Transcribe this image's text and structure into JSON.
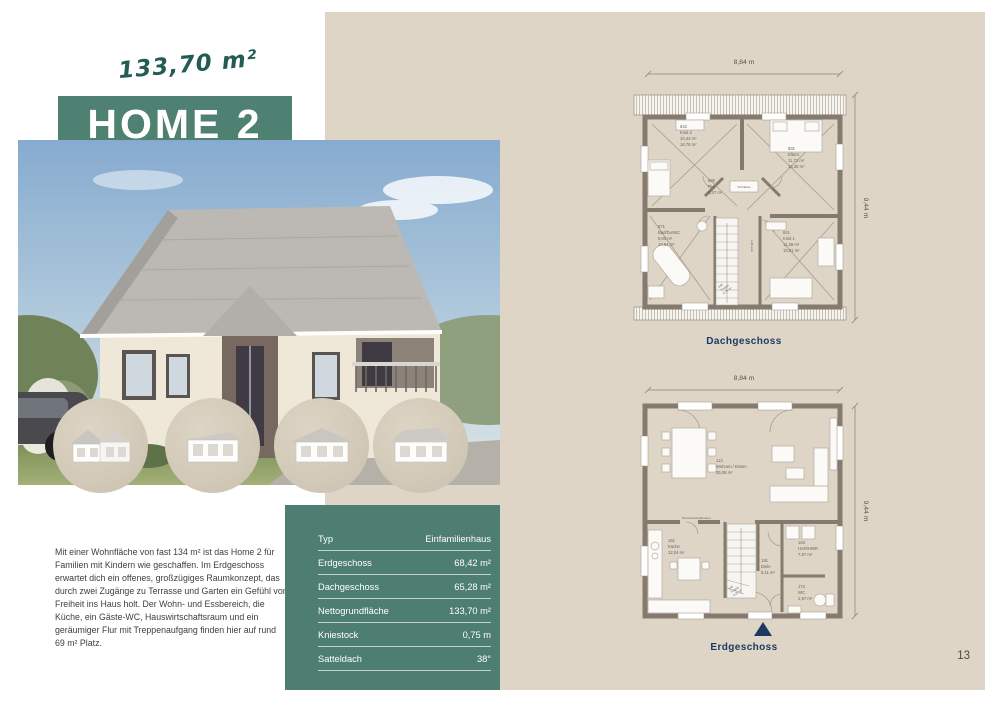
{
  "page": {
    "number": "13"
  },
  "header": {
    "area_label": "133,70 m²",
    "title": "HOME 2"
  },
  "intro": {
    "text": "Mit einer Wohnfläche von fast 134 m² ist das Home 2 für Familien mit Kindern wie geschaffen. Im Erdgeschoss erwartet dich ein offenes, großzügiges Raumkonzept, das durch zwei Zugänge zu Terrasse und Garten ein Gefühl von Freiheit ins Haus holt. Der Wohn- und Essbereich, die Küche, ein Gäste-WC, Hauswirtschaftsraum und ein geräumiger Flur mit Treppenaufgang finden hier auf rund 69 m² Platz."
  },
  "specs": {
    "rows": [
      {
        "label": "Typ",
        "value": "Einfamilienhaus"
      },
      {
        "label": "Erdgeschoss",
        "value": "68,42 m²"
      },
      {
        "label": "Dachgeschoss",
        "value": "65,28 m²"
      },
      {
        "label": "Nettogrundfläche",
        "value": "133,70 m²"
      },
      {
        "label": "Kniestock",
        "value": "0,75 m"
      },
      {
        "label": "Satteldach",
        "value": "38°"
      }
    ]
  },
  "thumbnails": [
    {
      "icon": "house-variant-1-icon"
    },
    {
      "icon": "house-variant-2-icon"
    },
    {
      "icon": "house-variant-3-icon"
    },
    {
      "icon": "house-variant-4-icon"
    }
  ],
  "plans": {
    "dachgeschoss": {
      "caption": "Dachgeschoss",
      "width_label": "8,84 m",
      "height_label": "9,44 m",
      "rooms": [
        {
          "id": "842",
          "name": "Kind 2",
          "area_reduced": "10,43 m²",
          "area_full": "16,78 m²"
        },
        {
          "id": "831",
          "name": "Eltern",
          "area_reduced": "11,71 m²",
          "area_full": "16,38 m²"
        },
        {
          "id": "886",
          "name": "Flur",
          "area_reduced": "3,47 m²"
        },
        {
          "id": "871",
          "name": "Bad/Du/WC",
          "area_reduced": "9,00 m²",
          "area_full": "10,84 m²"
        },
        {
          "id": "841",
          "name": "Kind 1",
          "area_reduced": "11,39 m²",
          "area_full": "19,01 m²"
        },
        {
          "id": "846",
          "name": "Treppe",
          "area_reduced": "4,70 m²"
        }
      ],
      "extra_labels": {
        "wardrobe": "Schränke",
        "void": "Luftraum"
      }
    },
    "erdgeschoss": {
      "caption": "Erdgeschoss",
      "width_label": "8,84 m",
      "height_label": "9,44 m",
      "rooms": [
        {
          "id": "113",
          "name": "Wohnen / Essen",
          "area": "35,08 m²"
        },
        {
          "id": "161",
          "name": "Küche",
          "area": "12,04 m²"
        },
        {
          "id": "191",
          "name": "Diele",
          "area": "6,11 m²"
        },
        {
          "id": "184",
          "name": "HAR/HWR",
          "area": "7,97 m²"
        },
        {
          "id": "172",
          "name": "WC",
          "area": "2,97 m²"
        },
        {
          "id": "146",
          "name": "Treppe",
          "area": "4,28 m²"
        }
      ],
      "extra_labels": {
        "utility": "Hauswirtschaftsraum"
      }
    }
  },
  "colors": {
    "accent_teal": "#4F8173",
    "table_teal": "#4D7E71",
    "script_teal": "#235B55",
    "navy": "#1C3A60",
    "beige_panel": "#DED5C6",
    "wall_gray": "#857A6D"
  }
}
